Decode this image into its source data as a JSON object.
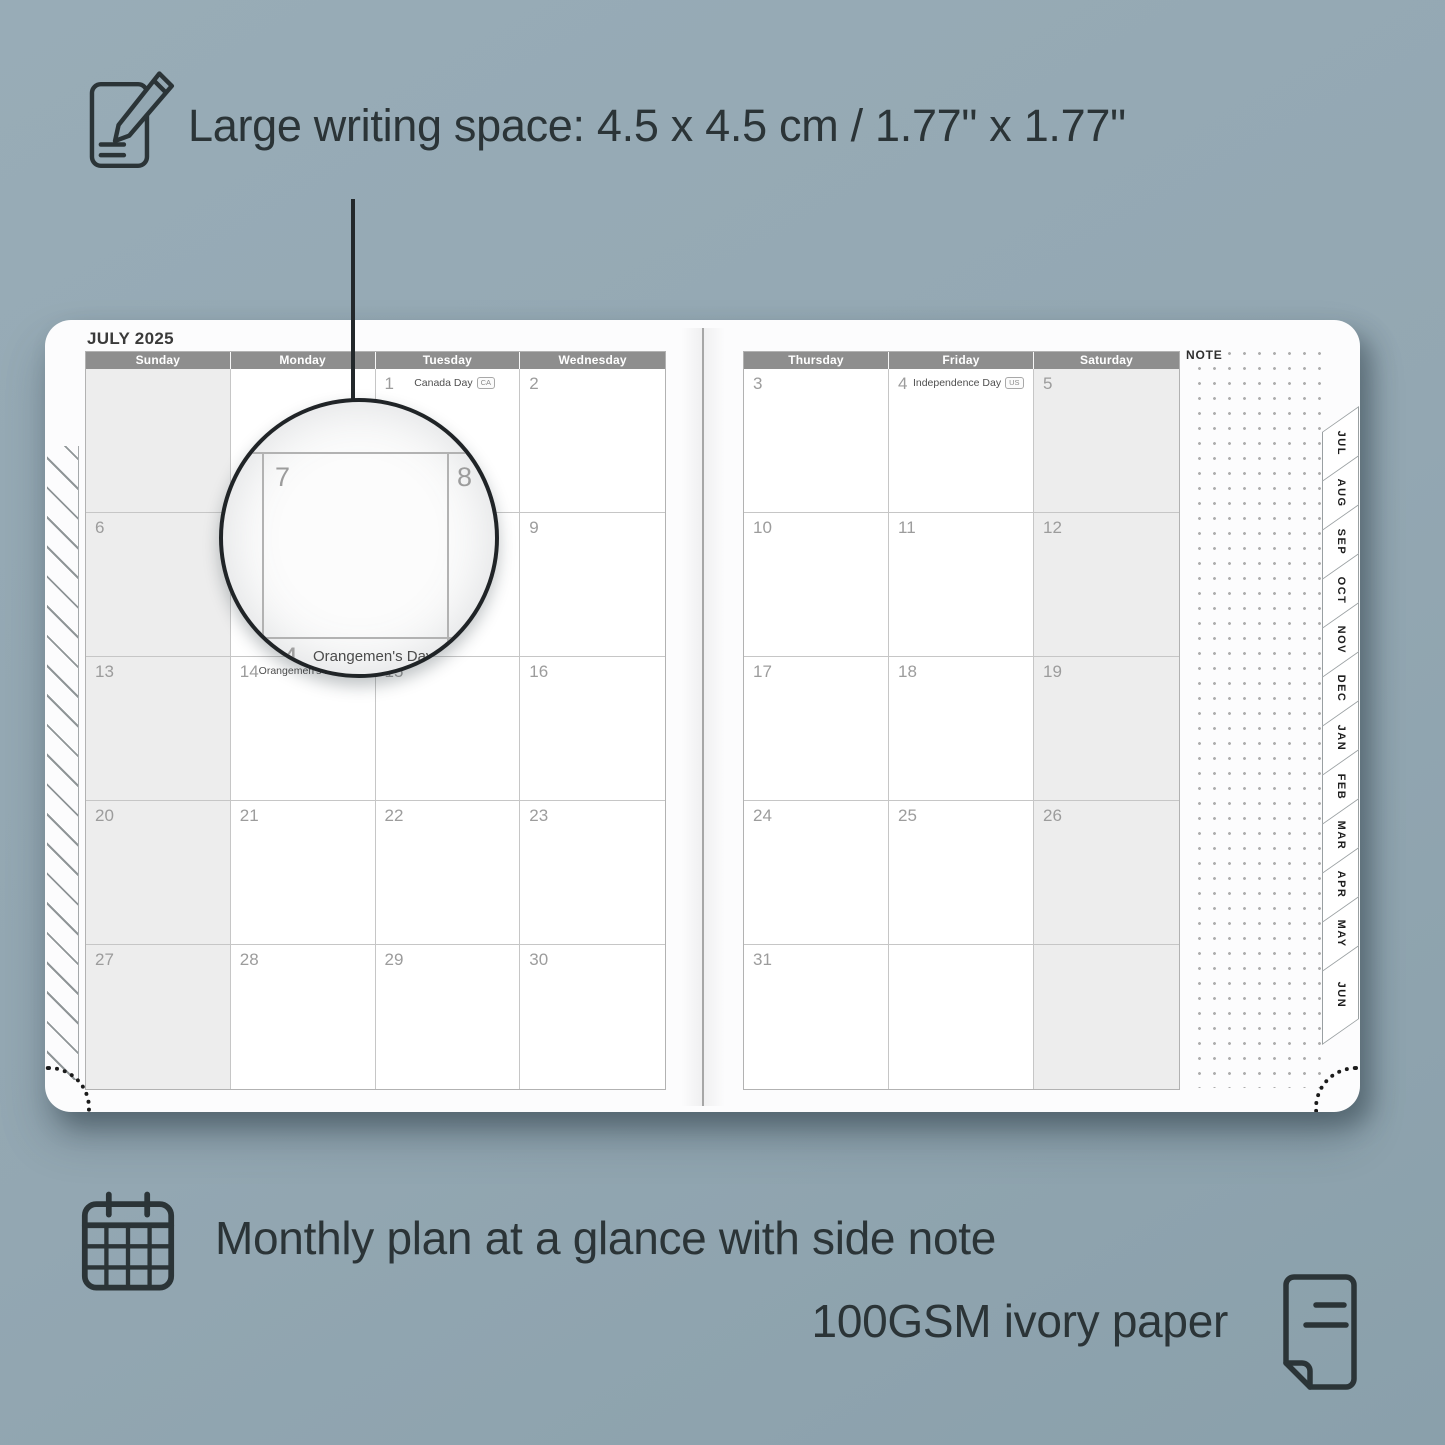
{
  "colors": {
    "background": "#93a7b2",
    "page": "#fcfcfd",
    "header_bar": "#8e8e8e",
    "weekend_cell": "#ededed",
    "day_number": "#9c9c9c",
    "annotation_text": "#2b3437",
    "grid_line": "#c6c6c6"
  },
  "annotations": {
    "top": {
      "icon": "pencil-note-icon",
      "text": "Large writing space: 4.5 x 4.5 cm / 1.77\" x 1.77\""
    },
    "bottom_first": {
      "icon": "calendar-grid-icon",
      "text": "Monthly plan at a glance with side note"
    },
    "bottom_second": {
      "icon": "paper-sheet-icon",
      "text": "100GSM ivory paper"
    }
  },
  "planner": {
    "month_title": "JULY 2025",
    "note_label": "NOTE",
    "month_tabs": [
      "JUL",
      "AUG",
      "SEP",
      "OCT",
      "NOV",
      "DEC",
      "JAN",
      "FEB",
      "MAR",
      "APR",
      "MAY",
      "JUN"
    ],
    "left_page": {
      "day_headers": [
        "Sunday",
        "Monday",
        "Tuesday",
        "Wednesday"
      ],
      "weekend_columns": [
        0
      ],
      "rows": [
        [
          {
            "day": ""
          },
          {
            "day": ""
          },
          {
            "day": "1",
            "holiday": "Canada Day",
            "badge": "CA"
          },
          {
            "day": "2"
          }
        ],
        [
          {
            "day": "6"
          },
          {
            "day": "7"
          },
          {
            "day": "8"
          },
          {
            "day": "9"
          }
        ],
        [
          {
            "day": "13"
          },
          {
            "day": "14",
            "holiday": "Orangemen's Day (n.i.)",
            "badge": "UK"
          },
          {
            "day": "15"
          },
          {
            "day": "16"
          }
        ],
        [
          {
            "day": "20"
          },
          {
            "day": "21"
          },
          {
            "day": "22"
          },
          {
            "day": "23"
          }
        ],
        [
          {
            "day": "27"
          },
          {
            "day": "28"
          },
          {
            "day": "29"
          },
          {
            "day": "30"
          }
        ]
      ]
    },
    "right_page": {
      "day_headers": [
        "Thursday",
        "Friday",
        "Saturday"
      ],
      "weekend_columns": [
        2
      ],
      "rows": [
        [
          {
            "day": "3"
          },
          {
            "day": "4",
            "holiday": "Independence Day",
            "badge": "US"
          },
          {
            "day": "5"
          }
        ],
        [
          {
            "day": "10"
          },
          {
            "day": "11"
          },
          {
            "day": "12"
          }
        ],
        [
          {
            "day": "17"
          },
          {
            "day": "18"
          },
          {
            "day": "19"
          }
        ],
        [
          {
            "day": "24"
          },
          {
            "day": "25"
          },
          {
            "day": "26"
          }
        ],
        [
          {
            "day": "31"
          },
          {
            "day": ""
          },
          {
            "day": ""
          }
        ]
      ]
    },
    "magnifier": {
      "cell_day": "7",
      "adjacent_day": "8",
      "below_day": "14",
      "below_holiday": "Orangemen's Day (n.i.)",
      "below_badge": "UK"
    }
  }
}
